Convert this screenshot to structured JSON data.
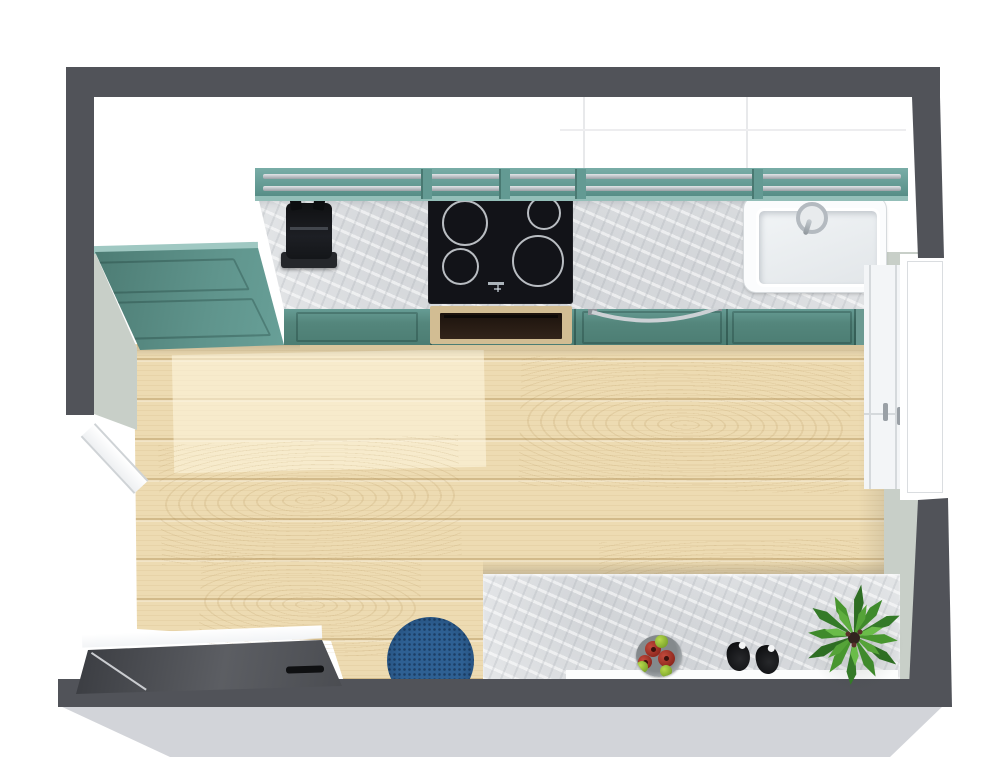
{
  "scene": {
    "title": "Kitchen 3D Floor Plan - Top View",
    "width": 1000,
    "height": 764
  },
  "palette": {
    "wall": "#515359",
    "wallFace": "#c8cfc8",
    "slab": "#d2d4d9",
    "tealTop": "#6ba29b",
    "tealFront": "#54867c",
    "tealLight": "#9fc8c2",
    "marble": "#e4e6e8",
    "wood": "#eddbb2",
    "rug": "#2e6093",
    "black": "#141518",
    "chrome": "#c6cbcf",
    "sinkWhite": "#fbfcfd",
    "ovenTan": "#d2bd93",
    "fruitRed": "#a93a2e",
    "fruitGreen": "#8fbf34",
    "plantGreen": "#4a9630",
    "doorLeaf": "#4a4c51",
    "floorPatch": "rgba(255,247,226,0.55)"
  },
  "structure": {
    "walls": [
      "top wall",
      "left wall",
      "right wall",
      "bottom wall"
    ],
    "floor_material": "light oak plank floor",
    "counter_material": "white-grey marble countertop",
    "cabinet_color": "teal shaker cabinets"
  },
  "openings": {
    "left_doorway": "open doorway with sill on left wall",
    "bottom_door": "dark door leaf along bottom wall",
    "right_window": "white framed casement window on right wall"
  },
  "appliances": [
    "espresso machine",
    "4-zone induction cooktop",
    "built-in wall oven",
    "single-basin sink with faucet"
  ],
  "cabinetry": [
    "tall teal pantry cabinet",
    "teal base cabinet run",
    "teal wall cabinet run with chrome rails",
    "white tall cabinets",
    "marble island counter"
  ],
  "decor": [
    "blue round rug",
    "fruit bowl with apples and limes",
    "salt and pepper grinders",
    "green potted plant"
  ]
}
